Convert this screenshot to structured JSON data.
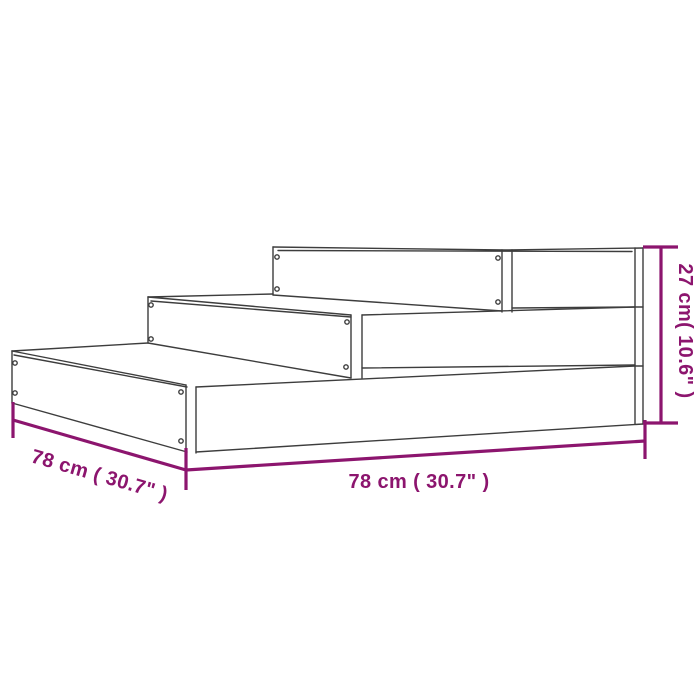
{
  "diagram": {
    "dimensions": {
      "depth_label": "78 cm ( 30.7\" )",
      "width_label": "78 cm ( 30.7\" )",
      "height_label": "27 cm( 10.6\" )"
    },
    "colors": {
      "dimension_accent": "#8C156E",
      "outline": "#3D3D3D",
      "background": "#FFFFFF"
    }
  }
}
